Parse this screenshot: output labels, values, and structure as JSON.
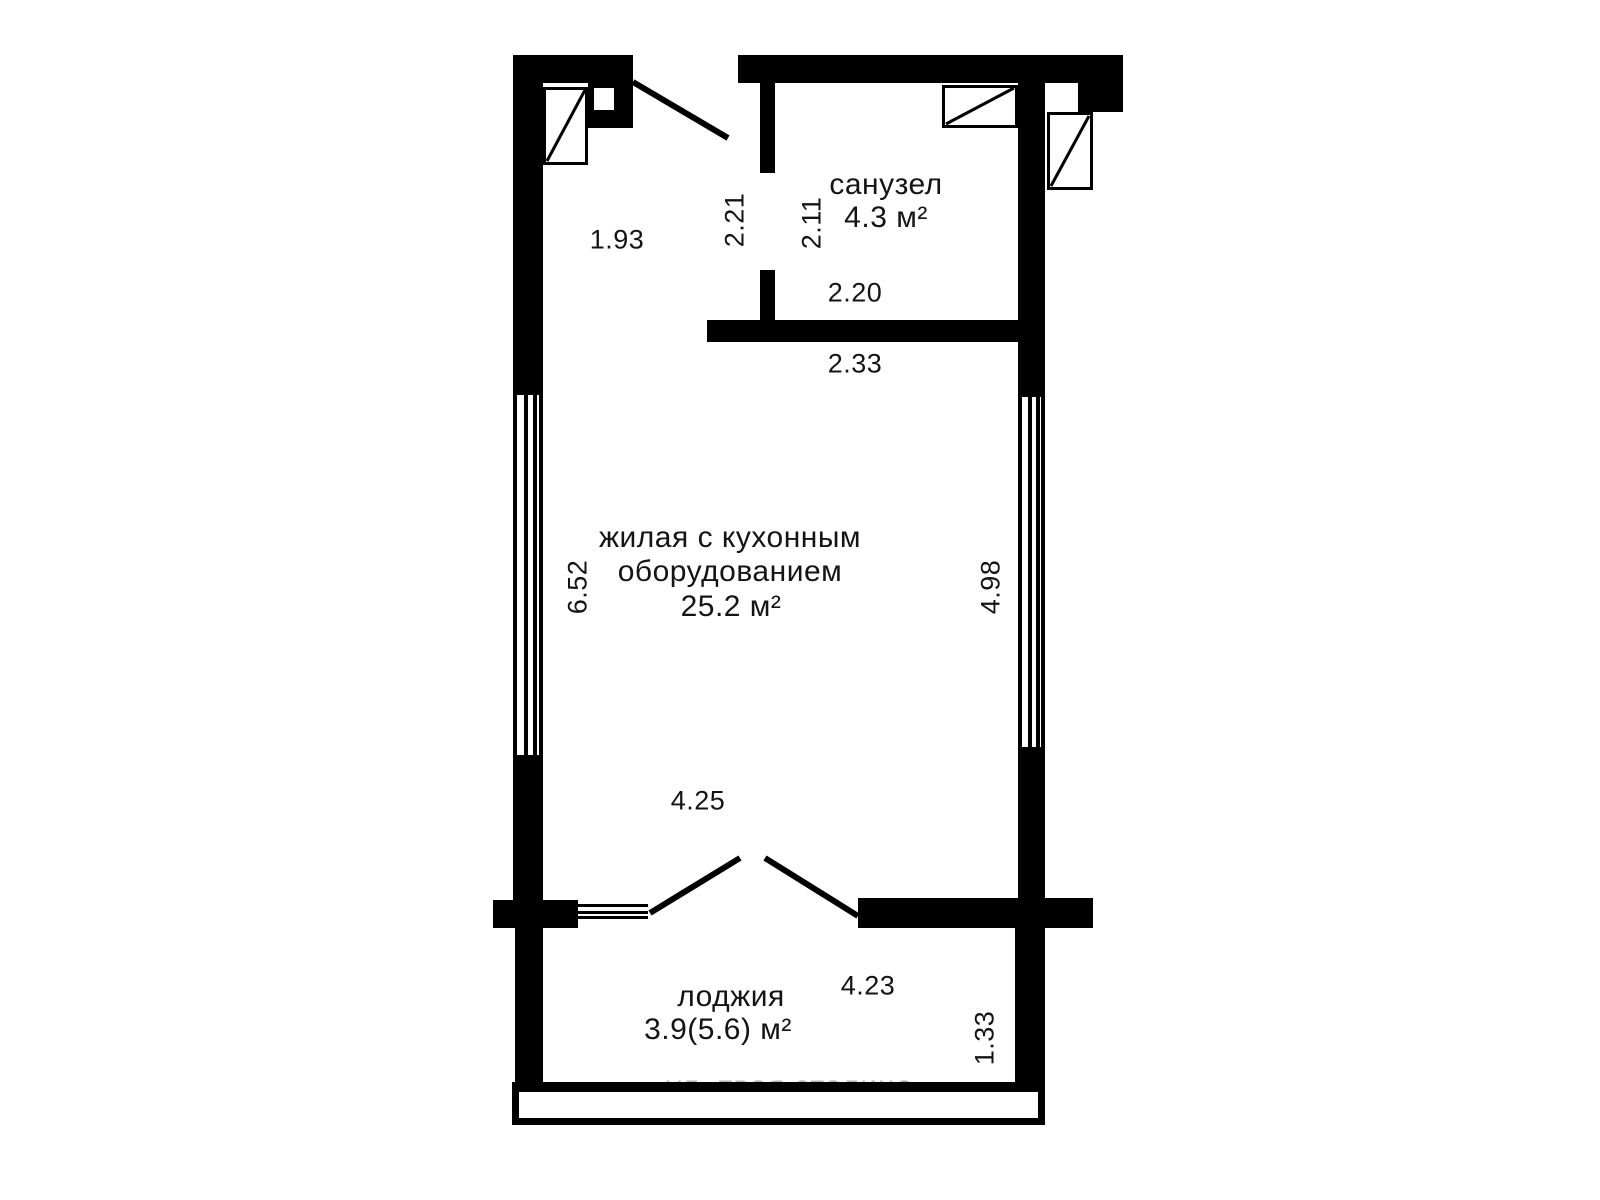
{
  "floorplan": {
    "rooms": {
      "bathroom": {
        "name": "санузел",
        "area": "4.3 м²"
      },
      "living": {
        "name_line1": "жилая с кухонным",
        "name_line2": "оборудованием",
        "area": "25.2 м²"
      },
      "loggia": {
        "name": "лоджия",
        "area": "3.9(5.6) м²"
      }
    },
    "dimensions": {
      "hall_width": "1.93",
      "hall_height": "2.21",
      "bathroom_height": "2.11",
      "bathroom_width": "2.20",
      "living_top_width": "2.33",
      "living_left_height": "6.52",
      "living_right_height": "4.98",
      "living_bottom_width": "4.25",
      "loggia_width": "4.23",
      "loggia_height": "1.33"
    },
    "watermark": "ул. твоя столица",
    "colors": {
      "wall": "#000000",
      "background": "#ffffff",
      "watermark": "#b6b6b6",
      "text": "#141414"
    }
  }
}
